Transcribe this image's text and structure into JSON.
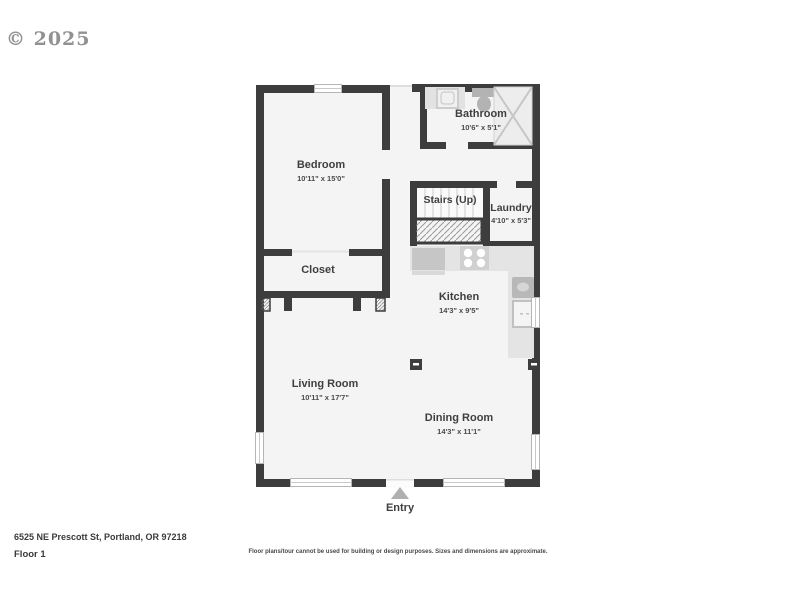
{
  "watermark": "© 2025",
  "rooms": {
    "bedroom": {
      "name": "Bedroom",
      "dims": "10'11\" x 15'0\""
    },
    "bathroom": {
      "name": "Bathroom",
      "dims": "10'6\" x 5'1\""
    },
    "stairs": {
      "name": "Stairs (Up)"
    },
    "laundry": {
      "name": "Laundry",
      "dims": "4'10\" x 5'3\""
    },
    "closet": {
      "name": "Closet"
    },
    "kitchen": {
      "name": "Kitchen",
      "dims": "14'3\" x 9'5\""
    },
    "living_room": {
      "name": "Living Room",
      "dims": "10'11\" x 17'7\""
    },
    "dining_room": {
      "name": "Dining Room",
      "dims": "14'3\" x 11'1\""
    }
  },
  "entry": {
    "label": "Entry"
  },
  "footer": {
    "address": "6525 NE Prescott St, Portland, OR 97218",
    "floor_label": "Floor 1",
    "disclaimer": "Floor plans/tour cannot be used for building or design purposes. Sizes and dimensions are approximate."
  },
  "colors": {
    "wall": "#3d3d3d",
    "floor": "#f4f4f4",
    "counter": "#e4e4e4",
    "fixture": "#c6c6c6",
    "window_border": "#b5b5b5",
    "text": "#3f3f3f",
    "entry_arrow": "#b0b0b0"
  }
}
